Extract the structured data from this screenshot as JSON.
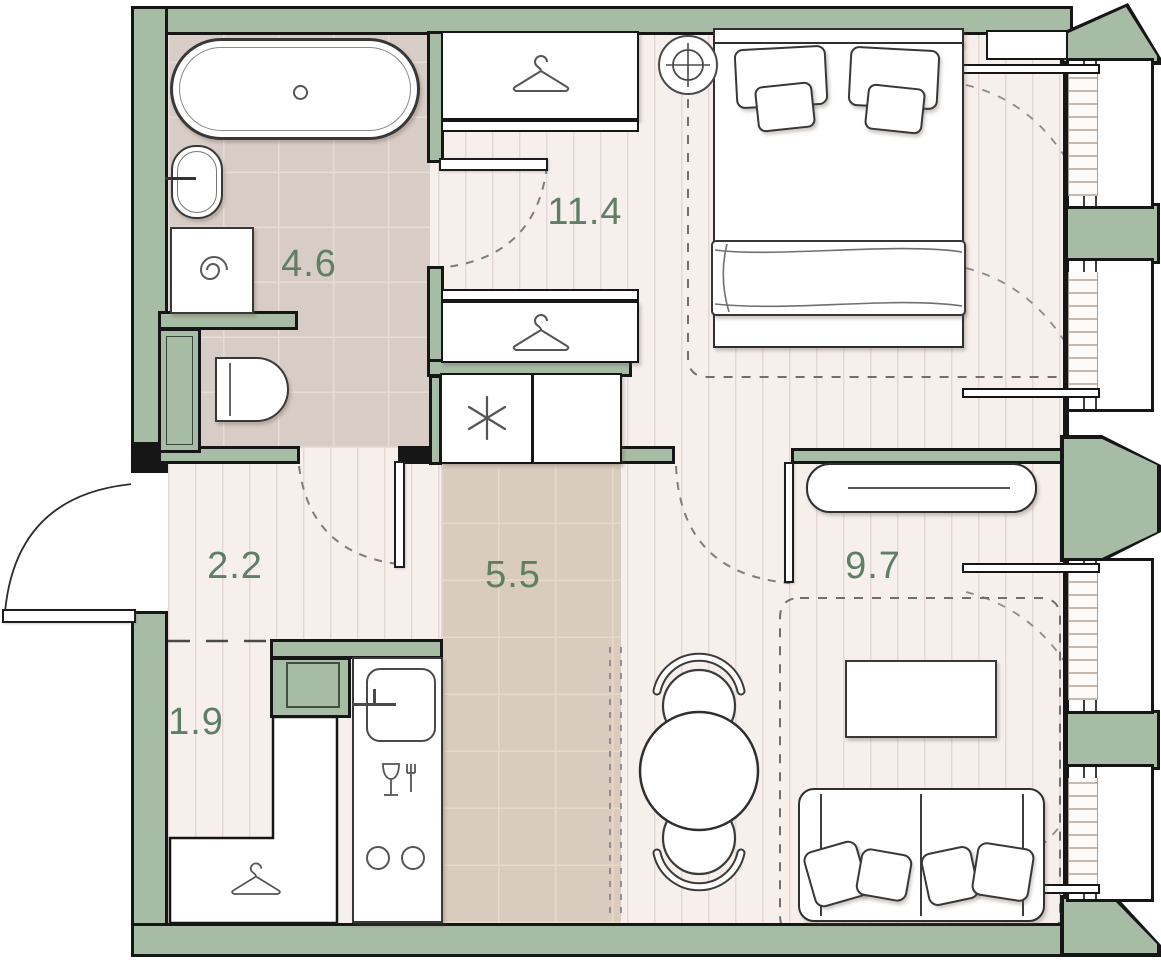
{
  "title": "one-room apartment floor plan",
  "rooms": [
    {
      "key": "bathroom",
      "area_label": "4.6"
    },
    {
      "key": "bedroom",
      "area_label": "11.4"
    },
    {
      "key": "hallway",
      "area_label": "2.2"
    },
    {
      "key": "kitchen",
      "area_label": "5.5"
    },
    {
      "key": "closet",
      "area_label": "1.9"
    },
    {
      "key": "living-room",
      "area_label": "9.7"
    }
  ],
  "colors": {
    "wall_fill": "#a7bca5",
    "wall_outline": "#161616",
    "room_label": "#5e7f63",
    "wood_floor": "#f6efec",
    "wood_stripe": "#e5d8d4",
    "bathroom_tile": "#d8cdc6",
    "kitchen_tile": "#d9ccbe",
    "furniture_outline": "#383838",
    "dash_line": "#7d7d7d"
  },
  "icons": {
    "wardrobe": "coat-hanger-icon",
    "washing_machine": "spiral-icon",
    "refrigerator": "asterisk-snowflake-icon",
    "dining_block": "wine-glass-fork-icon",
    "ceiling_light": "round-lamp-cross-icon",
    "hob": "two-burner-circles-icon",
    "bathtub_drain": "drain-circle-icon"
  },
  "fixtures": [
    "bathtub",
    "washbasin",
    "washing machine",
    "toilet",
    "double bed",
    "two wardrobes with hangers",
    "refrigerator cabinet",
    "kitchen counter with sink and hob",
    "round dining table with two chairs",
    "sofa with cushions",
    "coffee table",
    "console",
    "windows with radiators"
  ]
}
